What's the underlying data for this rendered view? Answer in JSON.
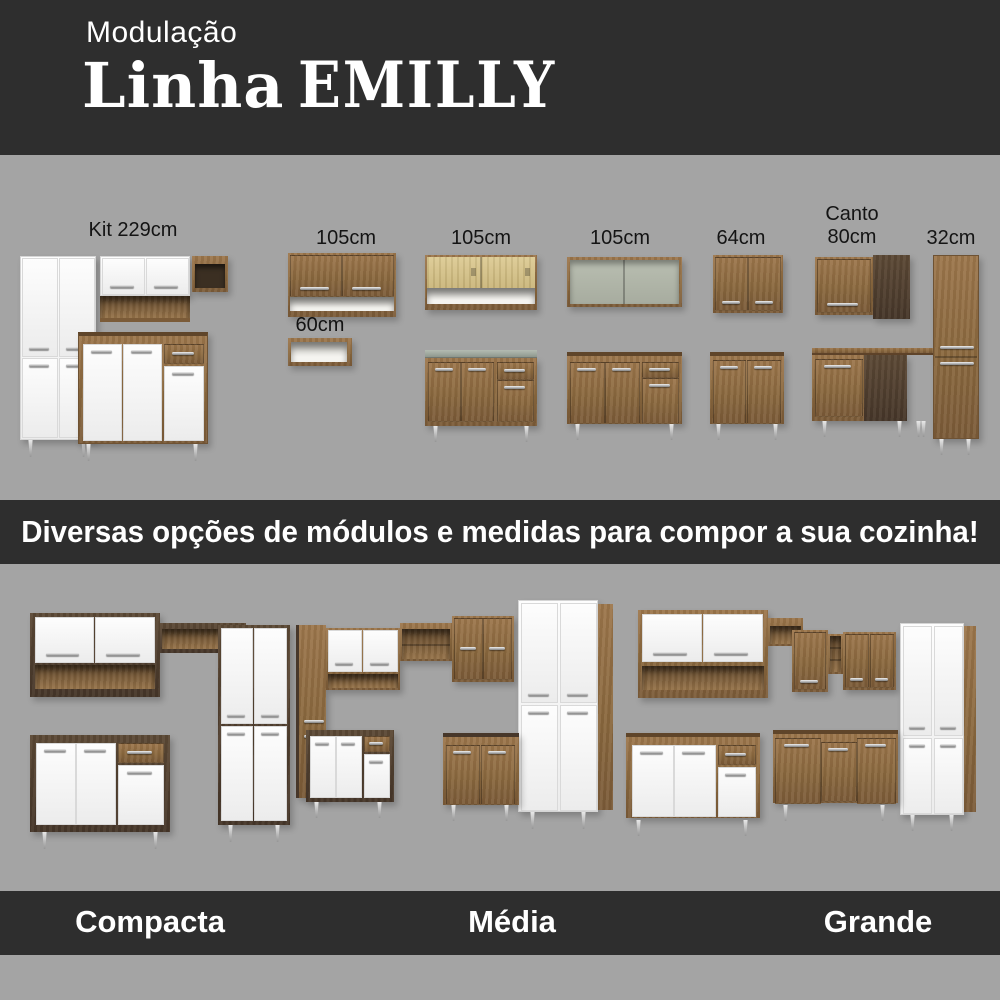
{
  "colors": {
    "background": "#a4a4a4",
    "band": "#2e2e2e",
    "text_light": "#ffffff",
    "text_dark": "#141414",
    "wood": "#8a683e",
    "walnut": "#4a3a2a",
    "white_door": "#f7f7f7"
  },
  "header": {
    "kicker": "Modulação",
    "title": "Linha",
    "brand": "EMILLY"
  },
  "modules": {
    "items": [
      {
        "id": "kit-229",
        "label": "Kit 229cm"
      },
      {
        "id": "wall-105-doors",
        "label": "105cm"
      },
      {
        "id": "niche-60",
        "label": "60cm"
      },
      {
        "id": "wall-105-sliding",
        "label": "105cm"
      },
      {
        "id": "wall-105-open",
        "label": "105cm"
      },
      {
        "id": "wall-64",
        "label": "64cm"
      },
      {
        "id": "corner-80",
        "line1": "Canto",
        "line2": "80cm"
      },
      {
        "id": "tall-32",
        "label": "32cm"
      }
    ]
  },
  "banner": {
    "text": "Diversas opções de módulos e medidas para compor a sua cozinha!"
  },
  "kitchens": {
    "items": [
      {
        "id": "compacta",
        "label": "Compacta"
      },
      {
        "id": "media",
        "label": "Média"
      },
      {
        "id": "grande",
        "label": "Grande"
      }
    ]
  }
}
